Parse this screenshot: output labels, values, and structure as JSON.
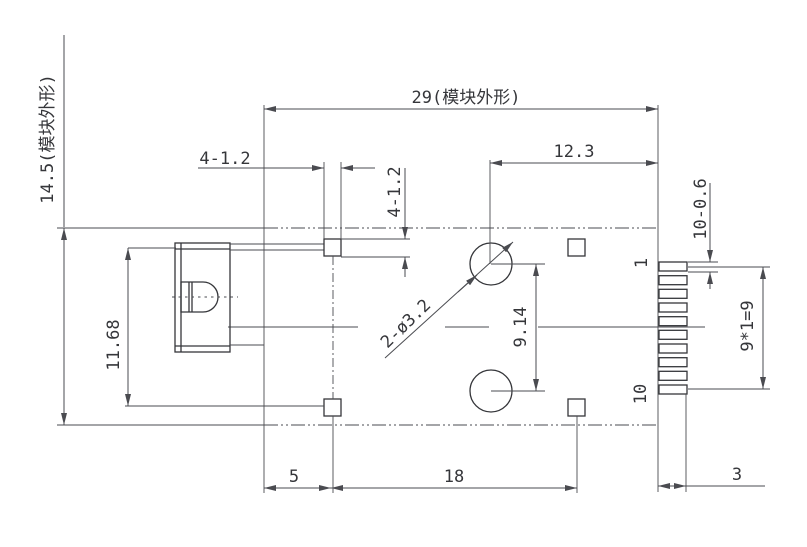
{
  "drawing": {
    "kind": "connector-module dimension drawing",
    "views": 1
  },
  "annotations": {
    "module_height": "14.5(模块外形)",
    "module_width": "29(模块外形)",
    "pad_width": "4-1.2",
    "pad_height": "4-1.2",
    "hole_to_edge": "12.3",
    "pin_size": "10-0.6",
    "pin_first": "1",
    "pin_last": "10",
    "pin_span": "9*1=9",
    "hole_spacing": "9.14",
    "holes": "2-ø3.2",
    "left_span": "11.68",
    "pad_left_offset": "5",
    "pad_spacing": "18",
    "tab_width": "3"
  },
  "features": {
    "pin_count": 10,
    "hole_count": 2,
    "pad_count": 4
  },
  "colors": {
    "line": "#35363a",
    "dim": "#4a4b50",
    "bg": "#ffffff"
  }
}
